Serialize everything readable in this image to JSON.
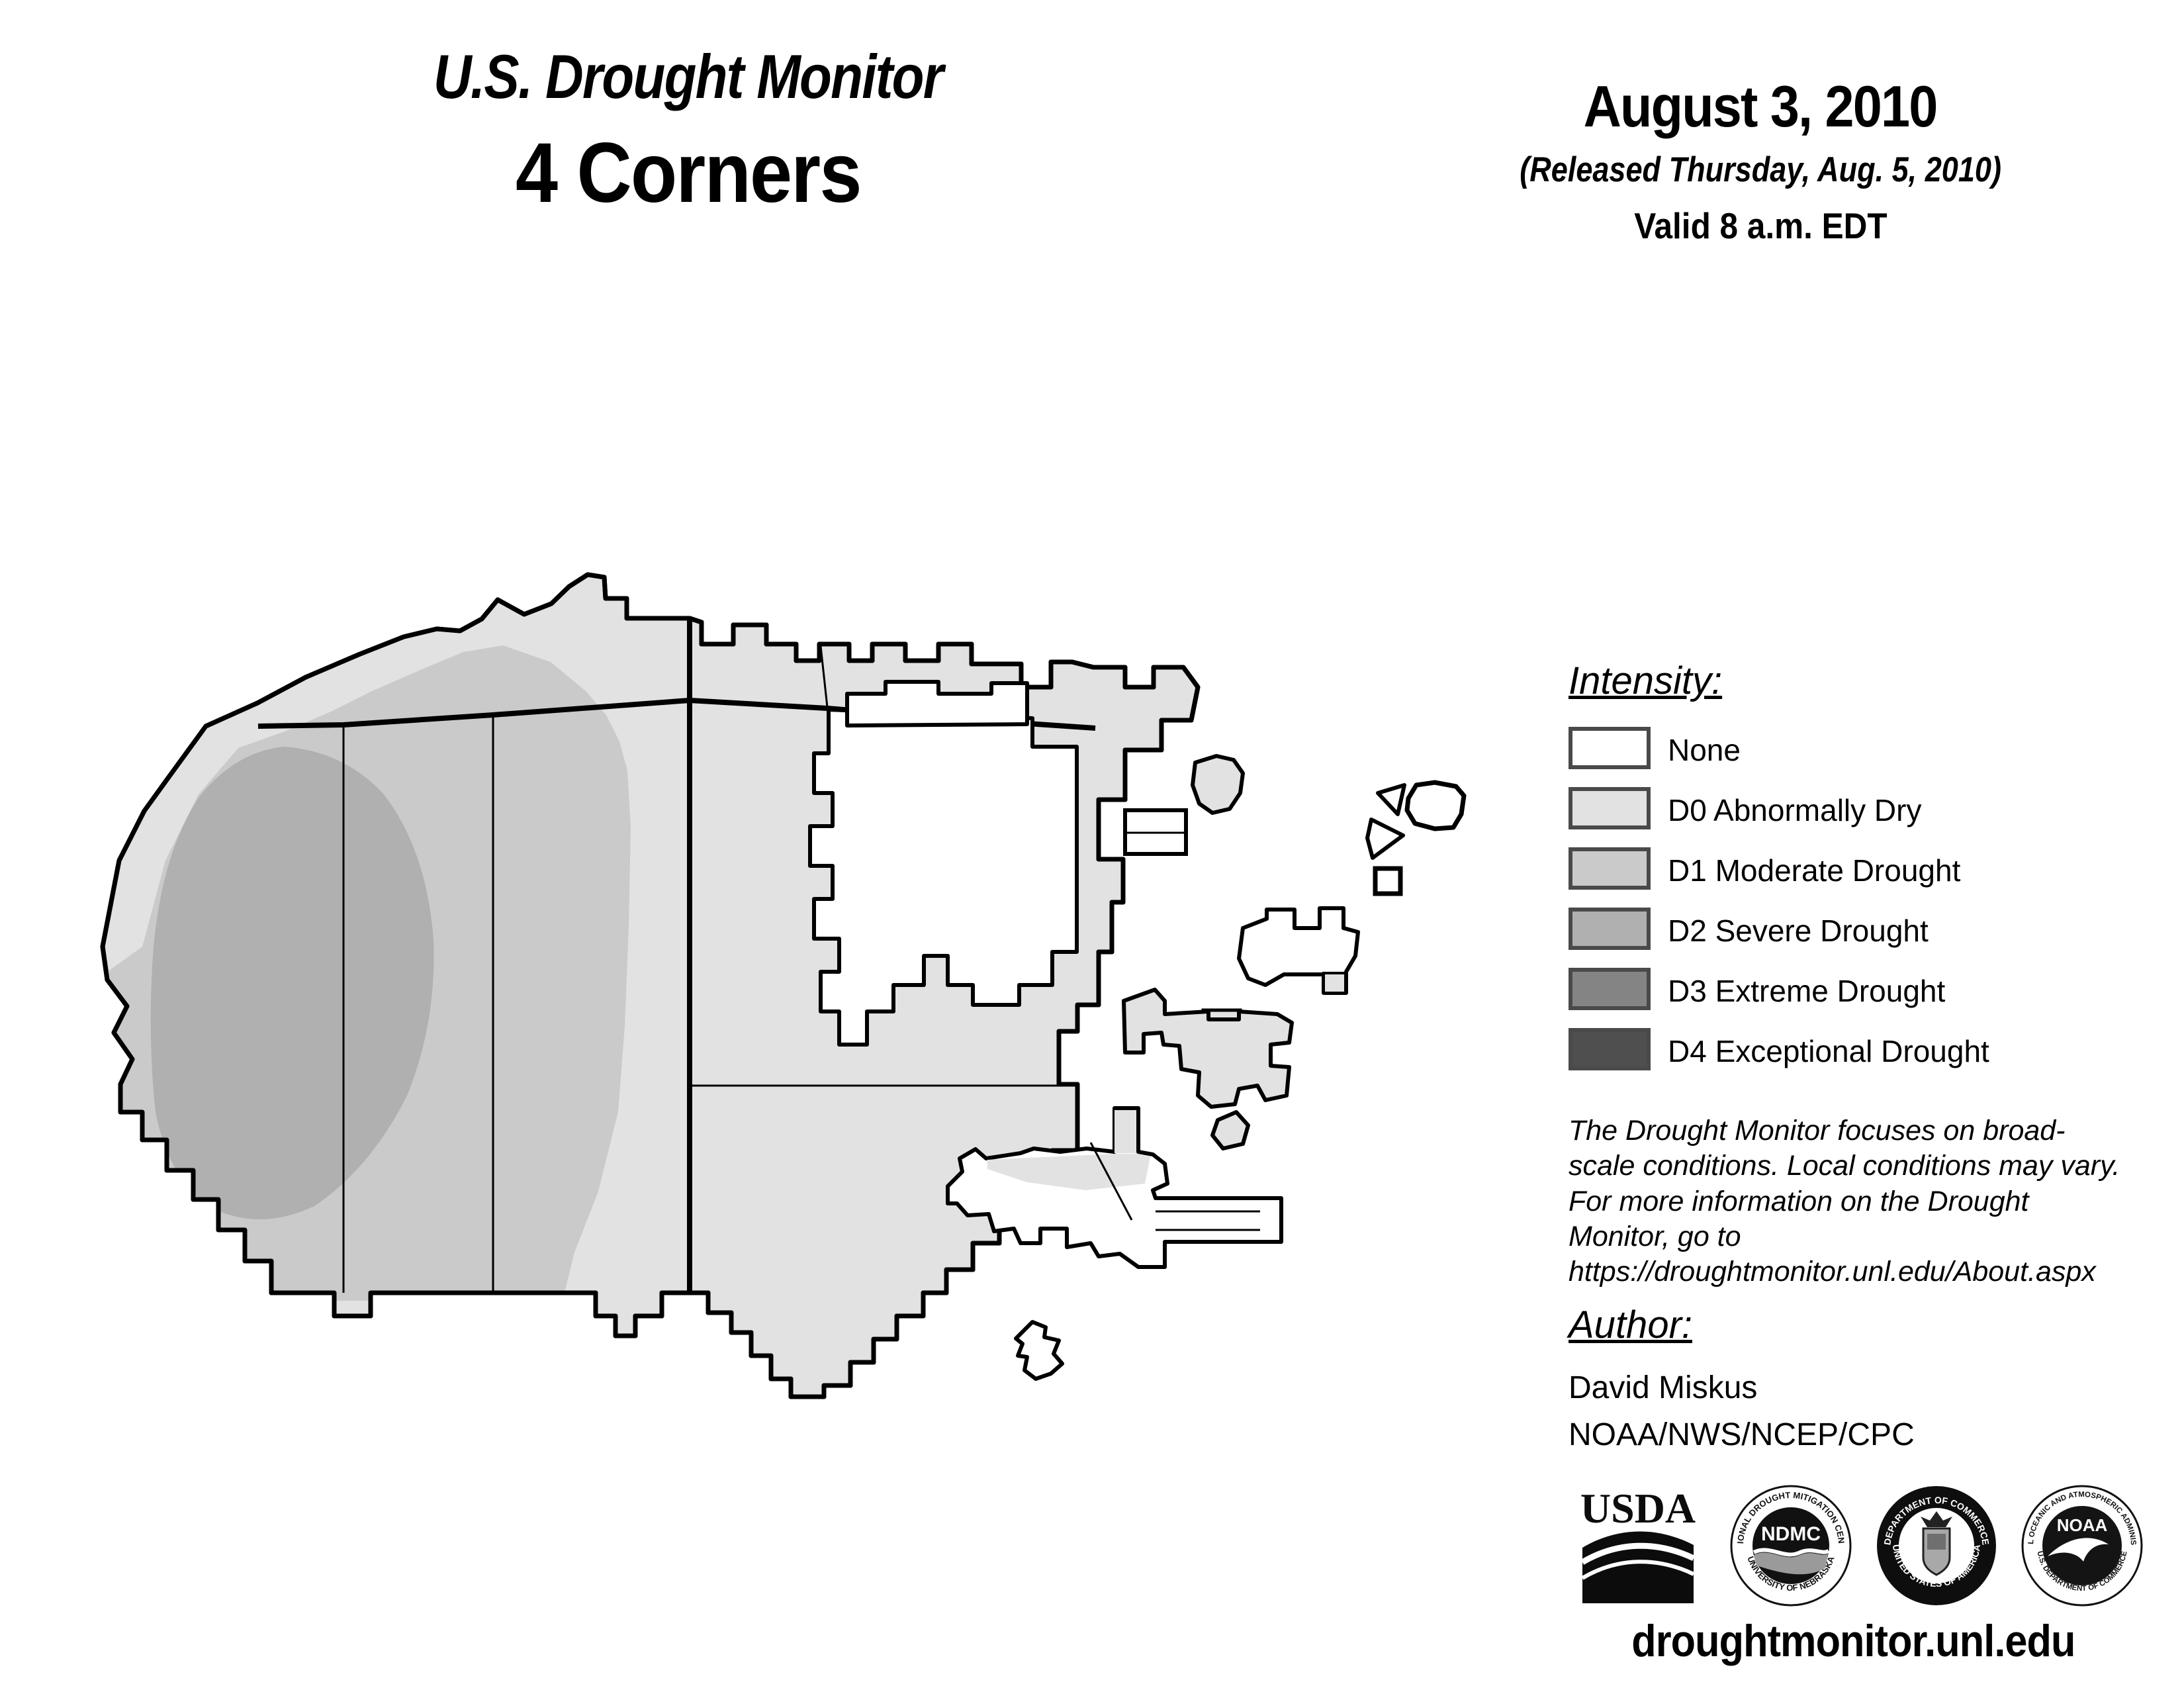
{
  "header": {
    "title": "U.S. Drought Monitor",
    "region": "4 Corners"
  },
  "date_block": {
    "date": "August 3, 2010",
    "released": "(Released Thursday, Aug. 5, 2010)",
    "valid": "Valid 8 a.m. EDT"
  },
  "legend": {
    "heading": "Intensity:",
    "items": [
      {
        "label": "None",
        "color": "#ffffff"
      },
      {
        "label": "D0 Abnormally Dry",
        "color": "#e2e2e2"
      },
      {
        "label": "D1 Moderate Drought",
        "color": "#cacaca"
      },
      {
        "label": "D2 Severe Drought",
        "color": "#b0b0b0"
      },
      {
        "label": "D3 Extreme Drought",
        "color": "#848484"
      },
      {
        "label": "D4 Exceptional Drought",
        "color": "#4f4f4f"
      }
    ],
    "swatch_border_color": "#4a4a4a"
  },
  "disclaimer": "The Drought Monitor focuses on broad-scale conditions. Local conditions may vary. For more information on the Drought Monitor, go to https://droughtmonitor.unl.edu/About.aspx",
  "author_block": {
    "heading": "Author:",
    "name": "David Miskus",
    "affiliation": "NOAA/NWS/NCEP/CPC"
  },
  "logos": [
    {
      "name": "USDA"
    },
    {
      "name": "NDMC",
      "ring_top": "NATIONAL DROUGHT MITIGATION CENTER",
      "ring_bottom": "UNIVERSITY OF NEBRASKA"
    },
    {
      "name": "Department of Commerce",
      "ring_top": "DEPARTMENT OF COMMERCE",
      "ring_bottom": "UNITED STATES OF AMERICA"
    },
    {
      "name": "NOAA",
      "ring_top": "NATIONAL OCEANIC AND ATMOSPHERIC ADMINISTRATION",
      "ring_bottom": "U.S. DEPARTMENT OF COMMERCE"
    }
  ],
  "footer": {
    "url": "droughtmonitor.unl.edu"
  },
  "map": {
    "description": "Grayscale drought intensity map of 4 Corners area tribal lands",
    "colors": {
      "none": "#ffffff",
      "d0": "#e2e2e2",
      "d1": "#cacaca",
      "d2": "#b0b0b0",
      "d3": "#848484",
      "d4": "#4f4f4f",
      "boundary": "#000000"
    },
    "levels_depicted": [
      "None",
      "D0",
      "D1",
      "D2"
    ],
    "shading_summary": {
      "d2_area": "northwest interior of main western region",
      "d1_area": "western and north-central portion of main region",
      "d0_area": "remainder of main region, fringes and most small eastern areas",
      "none_area": "north-central cutout, upper-right area and several small eastern polygons"
    }
  }
}
